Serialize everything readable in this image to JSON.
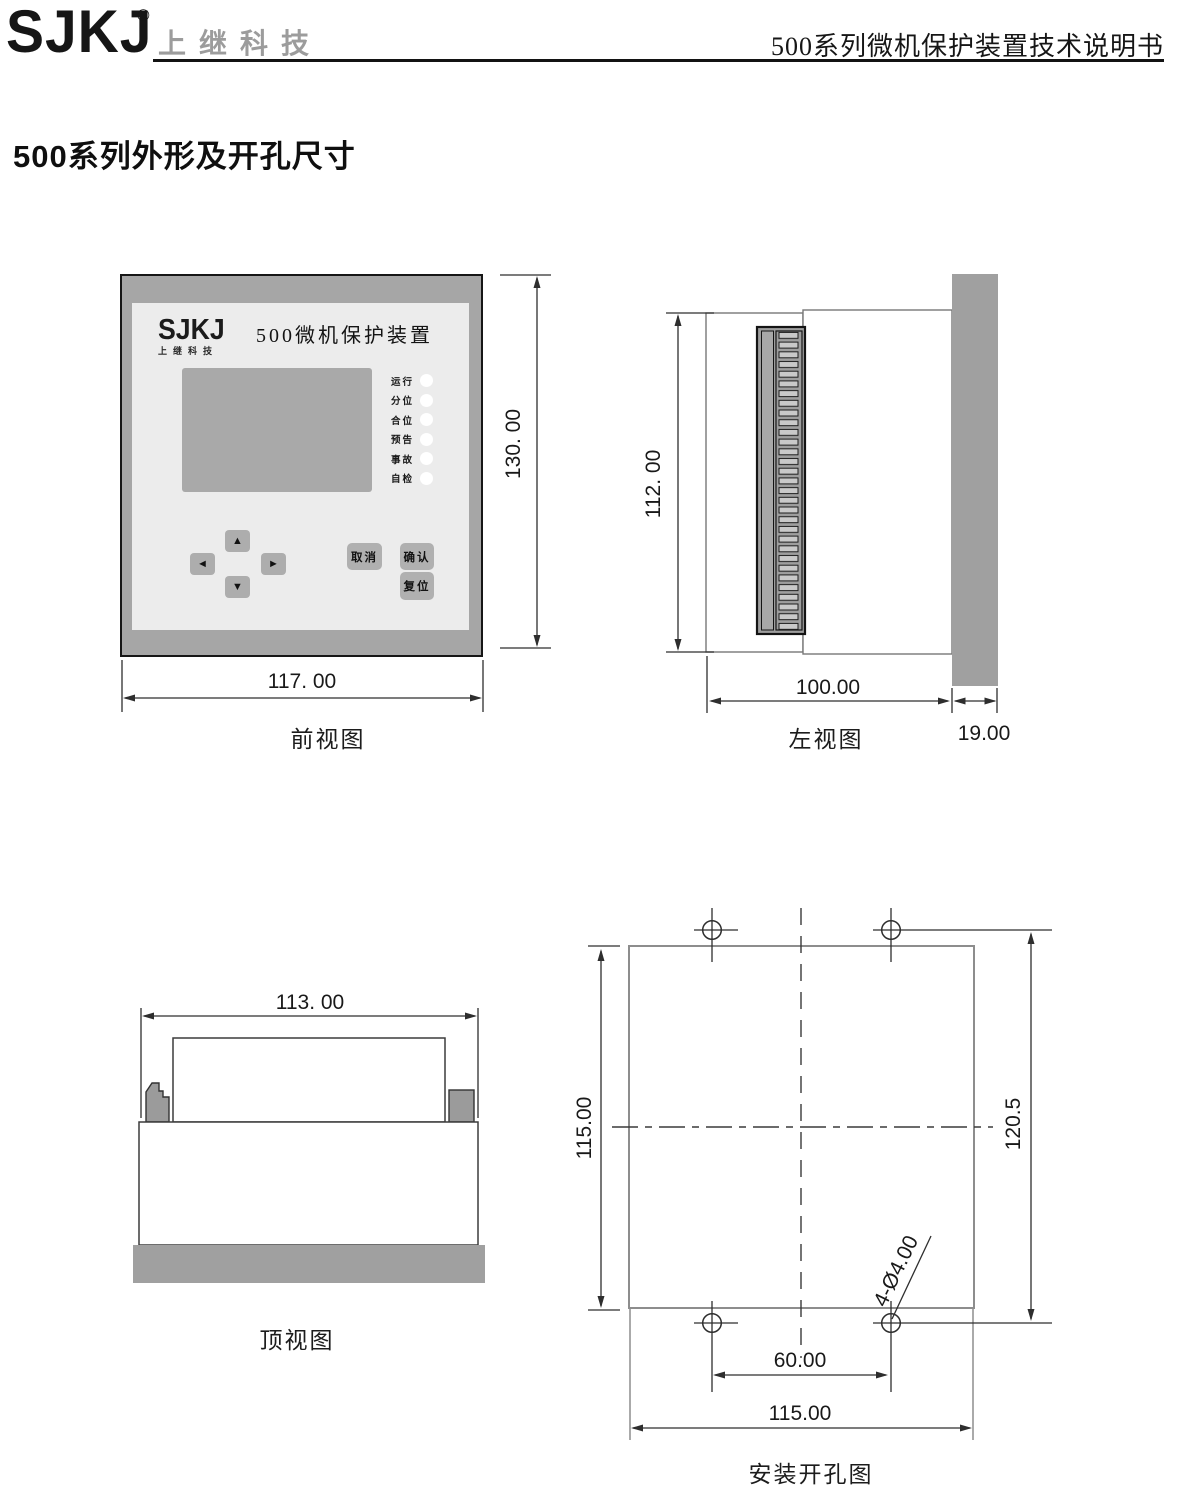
{
  "header": {
    "logo": "SJKJ",
    "registered_mark": "®",
    "brand_name": "上继科技",
    "doc_title": "500系列微机保护装置技术说明书"
  },
  "page_title": "500系列外形及开孔尺寸",
  "front_view": {
    "caption": "前视图",
    "device_panel": {
      "logo": "SJKJ",
      "logo_sub": "上继科技",
      "title": "500微机保护装置",
      "led_labels": [
        "运行",
        "分位",
        "合位",
        "预告",
        "事故",
        "自检"
      ],
      "nav_keys": {
        "up": "▲",
        "down": "▼",
        "left": "◄",
        "right": "►"
      },
      "buttons": {
        "cancel": "取消",
        "confirm": "确认",
        "reset": "复位"
      }
    },
    "dim_height": "130. 00",
    "dim_width": "117. 00"
  },
  "left_view": {
    "caption": "左视图",
    "dim_height": "112. 00",
    "dim_depth": "100.00",
    "dim_panel_thickness": "19.00"
  },
  "top_view": {
    "caption": "顶视图",
    "dim_width": "113. 00"
  },
  "install_view": {
    "caption": "安装开孔图",
    "dim_cutout_height": "115.00",
    "dim_hole_spacing_vertical": "120.5",
    "dim_hole_spacing_horizontal": "60.00",
    "dim_cutout_width": "115.00",
    "hole_label": "4-Ø4.00"
  },
  "colors": {
    "frame_gray": "#a6a6a6",
    "panel_gray": "#ececec",
    "lcd_gray": "#a9a9a9",
    "button_gray": "#b0b0b0",
    "strip_gray": "#a0a0a0"
  }
}
